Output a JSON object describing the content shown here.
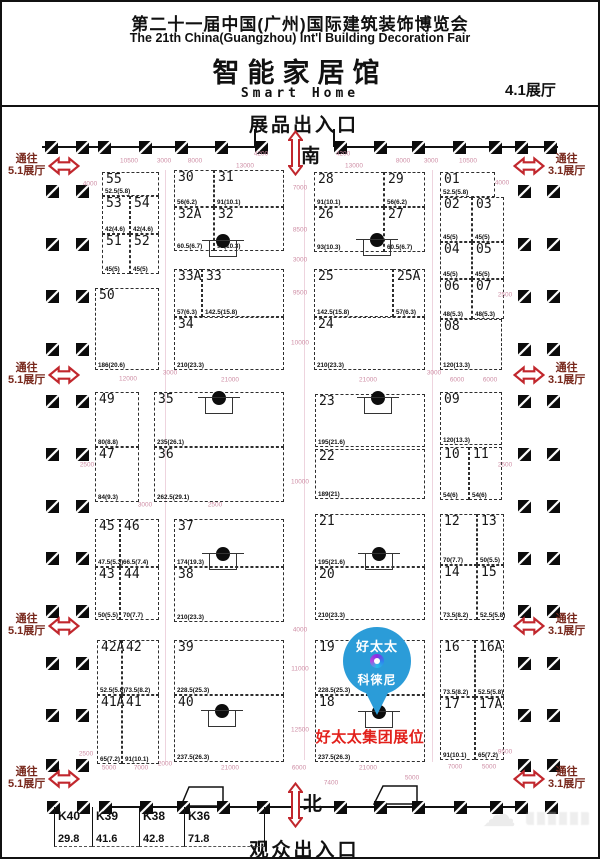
{
  "header": {
    "title_cn": "第二十一届中国(广州)国际建筑装饰博览会",
    "title_en": "The 21th China(Guangzhou) Int'l Building Decoration Fair",
    "hall_cn": "智能家居馆",
    "hall_en": "Smart Home",
    "hall_no": "4.1展厅"
  },
  "map": {
    "exhibit_entrance": "展品出入口",
    "visitor_entrance": "观众出入口",
    "south": "南",
    "north": "北",
    "to_hall_51": {
      "line1": "通往",
      "line2": "5.1展厅"
    },
    "to_hall_31": {
      "line1": "通往",
      "line2": "3.1展厅"
    },
    "gates": {
      "left_x": 6,
      "right_x": 511,
      "ys": [
        152,
        361,
        612,
        765
      ]
    }
  },
  "pin": {
    "brand_top": "好太太",
    "brand_bottom": "科徕尼",
    "label": "好太太集团展位",
    "color": "#2b9cd8",
    "label_color": "#e2211c"
  },
  "booths": [
    {
      "id": "55",
      "area": "52.5(5.8)",
      "x": 100,
      "y": 170,
      "w": 57,
      "h": 24
    },
    {
      "id": "53",
      "area": "42(4.6)",
      "x": 100,
      "y": 194,
      "w": 28,
      "h": 38
    },
    {
      "id": "54",
      "area": "42(4.6)",
      "x": 128,
      "y": 194,
      "w": 29,
      "h": 38
    },
    {
      "id": "51",
      "area": "45(5)",
      "x": 100,
      "y": 232,
      "w": 28,
      "h": 40
    },
    {
      "id": "52",
      "area": "45(5)",
      "x": 128,
      "y": 232,
      "w": 29,
      "h": 40
    },
    {
      "id": "50",
      "area": "186(20.6)",
      "x": 93,
      "y": 286,
      "w": 64,
      "h": 82
    },
    {
      "id": "30",
      "area": "56(6.2)",
      "x": 172,
      "y": 168,
      "w": 40,
      "h": 37
    },
    {
      "id": "31",
      "area": "91(10.1)",
      "x": 212,
      "y": 168,
      "w": 70,
      "h": 37
    },
    {
      "id": "32A",
      "area": "60.5(6.7)",
      "x": 172,
      "y": 205,
      "w": 40,
      "h": 44
    },
    {
      "id": "32",
      "area": "93(10.3)",
      "x": 212,
      "y": 205,
      "w": 70,
      "h": 44,
      "col": [
        220,
        239
      ]
    },
    {
      "id": "33A",
      "area": "57(6.3)",
      "x": 172,
      "y": 267,
      "w": 28,
      "h": 48
    },
    {
      "id": "33",
      "area": "142.5(15.8)",
      "x": 200,
      "y": 267,
      "w": 82,
      "h": 48
    },
    {
      "id": "34",
      "area": "210(23.3)",
      "x": 172,
      "y": 315,
      "w": 110,
      "h": 53
    },
    {
      "id": "28",
      "area": "91(10.1)",
      "x": 312,
      "y": 170,
      "w": 70,
      "h": 35
    },
    {
      "id": "29",
      "area": "56(6.2)",
      "x": 382,
      "y": 170,
      "w": 41,
      "h": 35
    },
    {
      "id": "26",
      "area": "93(10.3)",
      "x": 312,
      "y": 205,
      "w": 70,
      "h": 45,
      "col": [
        374,
        238
      ]
    },
    {
      "id": "27",
      "area": "60.5(6.7)",
      "x": 382,
      "y": 205,
      "w": 41,
      "h": 45
    },
    {
      "id": "25",
      "area": "142.5(15.8)",
      "x": 312,
      "y": 267,
      "w": 79,
      "h": 48
    },
    {
      "id": "25A",
      "area": "57(6.3)",
      "x": 391,
      "y": 267,
      "w": 32,
      "h": 48
    },
    {
      "id": "24",
      "area": "210(23.3)",
      "x": 312,
      "y": 315,
      "w": 111,
      "h": 53
    },
    {
      "id": "01",
      "area": "52.5(5.8)",
      "x": 438,
      "y": 170,
      "w": 55,
      "h": 25
    },
    {
      "id": "02",
      "area": "45(5)",
      "x": 438,
      "y": 195,
      "w": 32,
      "h": 45
    },
    {
      "id": "03",
      "area": "45(5)",
      "x": 470,
      "y": 195,
      "w": 32,
      "h": 45
    },
    {
      "id": "04",
      "area": "45(5)",
      "x": 438,
      "y": 240,
      "w": 32,
      "h": 37
    },
    {
      "id": "05",
      "area": "45(5)",
      "x": 470,
      "y": 240,
      "w": 32,
      "h": 37
    },
    {
      "id": "06",
      "area": "48(5.3)",
      "x": 438,
      "y": 277,
      "w": 32,
      "h": 40
    },
    {
      "id": "07",
      "area": "48(5.3)",
      "x": 470,
      "y": 277,
      "w": 32,
      "h": 40
    },
    {
      "id": "08",
      "area": "120(13.3)",
      "x": 438,
      "y": 317,
      "w": 62,
      "h": 51
    },
    {
      "id": "09",
      "area": "120(13.3)",
      "x": 438,
      "y": 390,
      "w": 62,
      "h": 53
    },
    {
      "id": "10",
      "area": "54(6)",
      "x": 438,
      "y": 445,
      "w": 29,
      "h": 53
    },
    {
      "id": "11",
      "area": "54(6)",
      "x": 467,
      "y": 445,
      "w": 33,
      "h": 53
    },
    {
      "id": "12",
      "area": "70(7.7)",
      "x": 438,
      "y": 512,
      "w": 37,
      "h": 51
    },
    {
      "id": "13",
      "area": "50(5.5)",
      "x": 475,
      "y": 512,
      "w": 27,
      "h": 51
    },
    {
      "id": "14",
      "area": "73.5(8.2)",
      "x": 438,
      "y": 563,
      "w": 37,
      "h": 55
    },
    {
      "id": "15",
      "area": "52.5(5.8)",
      "x": 475,
      "y": 563,
      "w": 27,
      "h": 55
    },
    {
      "id": "16",
      "area": "73.5(8.2)",
      "x": 438,
      "y": 638,
      "w": 35,
      "h": 57
    },
    {
      "id": "16A",
      "area": "52.5(5.8)",
      "x": 473,
      "y": 638,
      "w": 29,
      "h": 57
    },
    {
      "id": "17",
      "area": "91(10.1)",
      "x": 438,
      "y": 695,
      "w": 35,
      "h": 63
    },
    {
      "id": "17A",
      "area": "65(7.2)",
      "x": 473,
      "y": 695,
      "w": 29,
      "h": 63
    },
    {
      "id": "49",
      "area": "80(8.8)",
      "x": 93,
      "y": 390,
      "w": 44,
      "h": 55
    },
    {
      "id": "47",
      "area": "84(9.3)",
      "x": 93,
      "y": 445,
      "w": 44,
      "h": 55
    },
    {
      "id": "35",
      "area": "235(26.1)",
      "x": 152,
      "y": 390,
      "w": 130,
      "h": 55,
      "col": [
        216,
        396
      ]
    },
    {
      "id": "36",
      "area": "262.5(29.1)",
      "x": 152,
      "y": 445,
      "w": 130,
      "h": 55
    },
    {
      "id": "23",
      "area": "195(21.6)",
      "x": 313,
      "y": 392,
      "w": 110,
      "h": 53,
      "col": [
        375,
        396
      ]
    },
    {
      "id": "22",
      "area": "189(21)",
      "x": 313,
      "y": 447,
      "w": 110,
      "h": 50
    },
    {
      "id": "45",
      "area": "47.5(5.3)",
      "x": 93,
      "y": 517,
      "w": 25,
      "h": 48
    },
    {
      "id": "46",
      "area": "66.5(7.4)",
      "x": 118,
      "y": 517,
      "w": 39,
      "h": 48
    },
    {
      "id": "43",
      "area": "50(5.5)",
      "x": 93,
      "y": 565,
      "w": 25,
      "h": 53
    },
    {
      "id": "44",
      "area": "70(7.7)",
      "x": 118,
      "y": 565,
      "w": 39,
      "h": 53
    },
    {
      "id": "37",
      "area": "174(19.3)",
      "x": 172,
      "y": 517,
      "w": 110,
      "h": 48,
      "col": [
        220,
        552
      ]
    },
    {
      "id": "38",
      "area": "210(23.3)",
      "x": 172,
      "y": 565,
      "w": 110,
      "h": 55
    },
    {
      "id": "21",
      "area": "195(21.6)",
      "x": 313,
      "y": 512,
      "w": 110,
      "h": 53,
      "col": [
        376,
        552
      ]
    },
    {
      "id": "20",
      "area": "210(23.3)",
      "x": 313,
      "y": 565,
      "w": 110,
      "h": 53
    },
    {
      "id": "42A",
      "area": "52.5(5.8)",
      "x": 95,
      "y": 638,
      "w": 25,
      "h": 55
    },
    {
      "id": "42",
      "area": "73.5(8.2)",
      "x": 120,
      "y": 638,
      "w": 37,
      "h": 55
    },
    {
      "id": "41A",
      "area": "65(7.2)",
      "x": 95,
      "y": 693,
      "w": 25,
      "h": 69
    },
    {
      "id": "41",
      "area": "91(10.1)",
      "x": 120,
      "y": 693,
      "w": 37,
      "h": 69
    },
    {
      "id": "39",
      "area": "228.5(25.3)",
      "x": 172,
      "y": 638,
      "w": 110,
      "h": 55
    },
    {
      "id": "40",
      "area": "237.5(26.3)",
      "x": 172,
      "y": 693,
      "w": 110,
      "h": 67,
      "col": [
        219,
        709
      ]
    },
    {
      "id": "19",
      "area": "228.5(25.3)",
      "x": 313,
      "y": 638,
      "w": 110,
      "h": 55
    },
    {
      "id": "18",
      "area": "237.5(26.3)",
      "x": 313,
      "y": 693,
      "w": 110,
      "h": 67,
      "col": [
        376,
        710
      ]
    }
  ],
  "kiosks": [
    {
      "id": "K40",
      "area": "29.8",
      "x": 52,
      "w": 38
    },
    {
      "id": "K39",
      "area": "41.6",
      "x": 90,
      "w": 47
    },
    {
      "id": "K38",
      "area": "42.8",
      "x": 137,
      "w": 45
    },
    {
      "id": "K36",
      "area": "71.8",
      "x": 182,
      "w": 81
    }
  ],
  "dims": [
    [
      "10500",
      127,
      159
    ],
    [
      "3000",
      162,
      159
    ],
    [
      "8000",
      193,
      159
    ],
    [
      "13000",
      243,
      164
    ],
    [
      "4200",
      259,
      152
    ],
    [
      "4200",
      341,
      152
    ],
    [
      "13000",
      352,
      164
    ],
    [
      "8000",
      401,
      159
    ],
    [
      "3000",
      429,
      159
    ],
    [
      "10500",
      466,
      159
    ],
    [
      "4000",
      88,
      182
    ],
    [
      "4000",
      500,
      181
    ],
    [
      "7000",
      298,
      186
    ],
    [
      "8500",
      298,
      228
    ],
    [
      "3000",
      298,
      258
    ],
    [
      "9500",
      298,
      291
    ],
    [
      "10000",
      298,
      341
    ],
    [
      "12000",
      126,
      377
    ],
    [
      "3000",
      168,
      371
    ],
    [
      "21000",
      228,
      378
    ],
    [
      "21000",
      366,
      378
    ],
    [
      "3000",
      432,
      371
    ],
    [
      "6000",
      455,
      378
    ],
    [
      "6000",
      488,
      378
    ],
    [
      "2500",
      85,
      463
    ],
    [
      "2500",
      503,
      293
    ],
    [
      "2500",
      503,
      463
    ],
    [
      "3000",
      143,
      503
    ],
    [
      "2500",
      213,
      503
    ],
    [
      "10000",
      298,
      480
    ],
    [
      "4000",
      298,
      628
    ],
    [
      "11000",
      298,
      667
    ],
    [
      "12500",
      298,
      728
    ],
    [
      "2500",
      84,
      752
    ],
    [
      "9500",
      503,
      750
    ],
    [
      "5000",
      107,
      766
    ],
    [
      "7000",
      139,
      766
    ],
    [
      "2000",
      163,
      762
    ],
    [
      "21000",
      228,
      766
    ],
    [
      "6000",
      297,
      766
    ],
    [
      "21000",
      366,
      766
    ],
    [
      "7000",
      453,
      765
    ],
    [
      "5000",
      487,
      765
    ],
    [
      "7400",
      329,
      781
    ],
    [
      "5000",
      410,
      776
    ]
  ],
  "pillars": {
    "top": {
      "y": 139,
      "xs": [
        43,
        74,
        96,
        137,
        173,
        213,
        253,
        332,
        372,
        410,
        451,
        487,
        513,
        542
      ]
    },
    "bottom": {
      "y": 799,
      "xs": [
        45,
        75,
        97,
        138,
        175,
        215,
        255,
        332,
        372,
        410,
        452,
        488,
        513,
        543
      ]
    },
    "side_ys": [
      183,
      236,
      288,
      341,
      393,
      446,
      498,
      550,
      603,
      655,
      707,
      757
    ],
    "left_xs": [
      44,
      74
    ],
    "right_xs": [
      516,
      545
    ]
  },
  "colors": {
    "dim_text": "#cf8fa6",
    "arrow_red": "#c1272d",
    "gate_text": "#78281c"
  }
}
